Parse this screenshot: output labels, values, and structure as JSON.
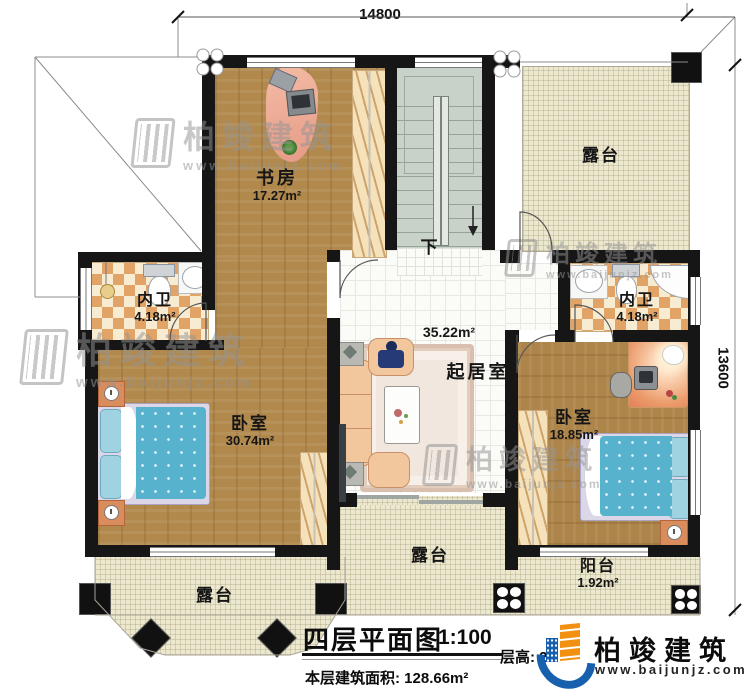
{
  "dimensions": {
    "top": "14800",
    "right": "13600"
  },
  "rooms": {
    "study": {
      "name": "书房",
      "area": "17.27m²"
    },
    "terrace_top": {
      "name": "露台"
    },
    "bath_left": {
      "name": "内卫",
      "area": "4.18m²"
    },
    "bath_right": {
      "name": "内卫",
      "area": "4.18m²"
    },
    "bedroom_left": {
      "name": "卧室",
      "area": "30.74m²"
    },
    "living": {
      "name": "起居室",
      "area": "35.22m²"
    },
    "bedroom_right": {
      "name": "卧室",
      "area": "18.85m²"
    },
    "terrace_mid": {
      "name": "露台"
    },
    "terrace_bay": {
      "name": "露台"
    },
    "balcony": {
      "name": "阳台",
      "area": "1.92m²"
    }
  },
  "stairs": {
    "direction_label": "下"
  },
  "title_block": {
    "title": "四层平面图",
    "scale": "1:100",
    "area_label": "本层建筑面积:",
    "area_value": "128.66m²",
    "height_label": "层高:",
    "height_value": "2"
  },
  "brand": {
    "name": "柏竣建筑",
    "website": "www.baijunjz.com"
  },
  "watermark": {
    "name": "柏竣建筑",
    "website": "www.baijunjz.com"
  },
  "colors": {
    "wall": "#161616",
    "wood_floor": "#b2894d",
    "tile_orange": "#e2a367",
    "terrace": "#ece7cf",
    "bed": "#57b3cd",
    "brand_blue": "#1660ae",
    "brand_orange": "#f29111"
  }
}
